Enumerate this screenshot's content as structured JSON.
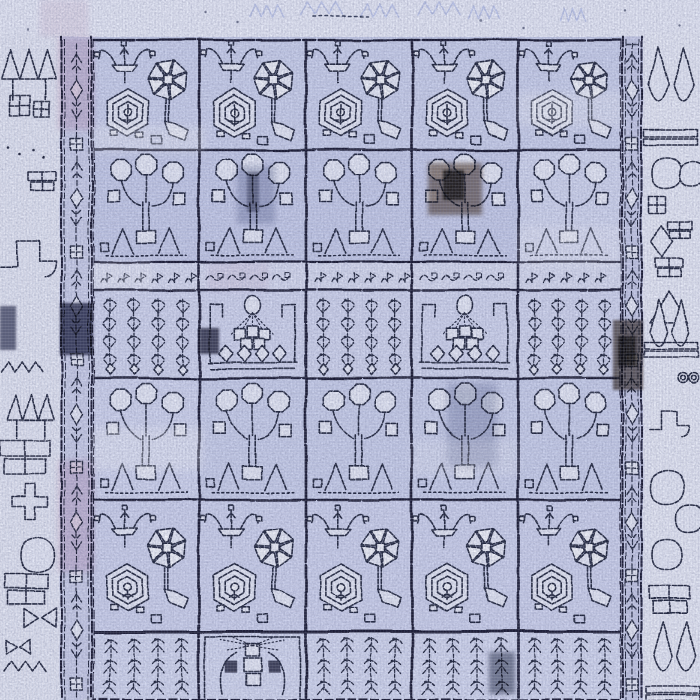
{
  "scene": {
    "description": "Worn blue and ivory Persian Bakhtiari-style panel rug, photographed flat: a grid of garden compartments with hexagon medallions, pinwheel flowers, balloon-flower bouquets, willow trees and niche baskets, framed by chain guard stripes and pale outer borders with geometric motifs",
    "palette": {
      "ink": "#1e2238",
      "ink_strong": "#14182e",
      "page_bg": "#e7eaf6",
      "top_strip": "#e9ecf9",
      "outer_left_bg": "#e6e9f6",
      "outer_right_bg": "#e9ecf8",
      "field_bg": "#c9cfec",
      "guard_bg": "#ccd0eb",
      "guard_bg_right": "#c8cce9",
      "band_bg": "#d9ddf2",
      "motif_light": "#e8ebf8",
      "motif_white": "#f3f5fc",
      "ghost": "#bfc8ec",
      "pink": "#dfaec4"
    },
    "field": {
      "x": 93,
      "y": 37,
      "w": 528,
      "h": 663
    },
    "cols": [
      {
        "x": 93,
        "w": 106
      },
      {
        "x": 199,
        "w": 107
      },
      {
        "x": 306,
        "w": 106
      },
      {
        "x": 412,
        "w": 106
      },
      {
        "x": 518,
        "w": 103
      }
    ],
    "rows": [
      {
        "name": "r1",
        "y": 40,
        "h": 110,
        "fill": "#ccd2ee",
        "types": [
          "garden",
          "garden",
          "garden",
          "garden",
          "garden"
        ]
      },
      {
        "name": "r2",
        "y": 150,
        "h": 112,
        "fill": "#c7cdeb",
        "types": [
          "balloons",
          "balloons",
          "balloons",
          "balloons",
          "balloons"
        ]
      },
      {
        "name": "band",
        "y": 262,
        "h": 28,
        "fill": "#d9ddf2",
        "types": [
          "glyphsA",
          "glyphsB",
          "glyphsA",
          "glyphsB",
          "glyphsA"
        ]
      },
      {
        "name": "r3",
        "y": 290,
        "h": 88,
        "fill": "#d2d7f0",
        "types": [
          "willow",
          "basket",
          "willow",
          "basket",
          "willow"
        ]
      },
      {
        "name": "r4",
        "y": 378,
        "h": 122,
        "fill": "#cbd1ed",
        "types": [
          "balloons",
          "balloons",
          "balloons",
          "balloons",
          "balloons"
        ]
      },
      {
        "name": "r5",
        "y": 500,
        "h": 132,
        "fill": "#cfd4ef",
        "types": [
          "garden",
          "garden",
          "garden",
          "garden",
          "garden"
        ]
      },
      {
        "name": "r6",
        "y": 632,
        "h": 68,
        "fill": "#d5daf2",
        "types": [
          "willowup",
          "fantree",
          "willowup",
          "willowup",
          "willowup"
        ]
      }
    ],
    "fill_overrides": [
      {
        "r": 1,
        "c": 4,
        "fill": "#d3d8f1"
      },
      {
        "r": 4,
        "c": 0,
        "fill": "#d2d7f1"
      }
    ],
    "guards": [
      {
        "name": "left-guard-stripe",
        "x": 60,
        "w": 33,
        "bg": "#ccd0eb"
      },
      {
        "name": "right-guard-stripe",
        "x": 621,
        "w": 22,
        "bg": "#c8cce9"
      }
    ],
    "outer_motifs": [
      {
        "t": "crown",
        "x": 2,
        "y": 46,
        "s": 54
      },
      {
        "t": "sqx",
        "x": 10,
        "y": 96,
        "s": 20
      },
      {
        "t": "sqx",
        "x": 34,
        "y": 102,
        "s": 15
      },
      {
        "t": "specks",
        "x": 8,
        "y": 148,
        "s": 40
      },
      {
        "t": "shelf",
        "x": 28,
        "y": 172,
        "s": 28
      },
      {
        "t": "hook",
        "x": 0,
        "y": 228,
        "s": 56
      },
      {
        "t": "birdm",
        "x": 2,
        "y": 362,
        "s": 48
      },
      {
        "t": "crown",
        "x": 8,
        "y": 392,
        "s": 46
      },
      {
        "t": "shelf",
        "x": 0,
        "y": 440,
        "s": 50
      },
      {
        "t": "cross",
        "x": 12,
        "y": 484,
        "s": 36
      },
      {
        "t": "blob",
        "x": 20,
        "y": 538,
        "s": 34
      },
      {
        "t": "shelf",
        "x": 4,
        "y": 574,
        "s": 44
      },
      {
        "t": "bowtie",
        "x": 24,
        "y": 608,
        "s": 32
      },
      {
        "t": "bowtie",
        "x": 6,
        "y": 640,
        "s": 24
      },
      {
        "t": "birdm",
        "x": 4,
        "y": 662,
        "s": 50
      },
      {
        "t": "leafpair",
        "x": 648,
        "y": 48,
        "s": 46
      },
      {
        "t": "hbar",
        "x": 644,
        "y": 130,
        "s": 54
      },
      {
        "t": "blob",
        "x": 652,
        "y": 158,
        "s": 30
      },
      {
        "t": "blob",
        "x": 680,
        "y": 162,
        "s": 24
      },
      {
        "t": "sqx",
        "x": 649,
        "y": 196,
        "s": 17
      },
      {
        "t": "diamond",
        "x": 651,
        "y": 226,
        "s": 22
      },
      {
        "t": "shelf",
        "x": 668,
        "y": 222,
        "s": 24
      },
      {
        "t": "shelf",
        "x": 655,
        "y": 258,
        "s": 28
      },
      {
        "t": "tri",
        "x": 650,
        "y": 292,
        "s": 38
      },
      {
        "t": "leafpair",
        "x": 650,
        "y": 300,
        "s": 40
      },
      {
        "t": "hbar",
        "x": 644,
        "y": 342,
        "s": 54
      },
      {
        "t": "scroll88",
        "x": 682,
        "y": 378,
        "s": 18
      },
      {
        "t": "hook",
        "x": 650,
        "y": 402,
        "s": 40
      },
      {
        "t": "blob",
        "x": 650,
        "y": 470,
        "s": 34
      },
      {
        "t": "blob",
        "x": 676,
        "y": 505,
        "s": 28
      },
      {
        "t": "blob",
        "x": 652,
        "y": 540,
        "s": 30
      },
      {
        "t": "shelf",
        "x": 650,
        "y": 586,
        "s": 40
      },
      {
        "t": "leafpair",
        "x": 654,
        "y": 622,
        "s": 42
      },
      {
        "t": "hbar",
        "x": 646,
        "y": 686,
        "s": 54
      }
    ],
    "top_strip": {
      "h": 37,
      "ghosts": [
        [
          250,
          4,
          40
        ],
        [
          300,
          2,
          50
        ],
        [
          360,
          4,
          46
        ],
        [
          418,
          2,
          50
        ],
        [
          468,
          6,
          36
        ],
        [
          560,
          8,
          30
        ]
      ],
      "dotted_line": [
        312,
        16,
        368,
        16
      ],
      "specks": [
        [
          238,
          22
        ],
        [
          480,
          20
        ],
        [
          523,
          28
        ],
        [
          205,
          12
        ],
        [
          624,
          10
        ],
        [
          680,
          26
        ],
        [
          28,
          30
        ]
      ]
    },
    "worn_patches": [
      {
        "x": 60,
        "y": 303,
        "w": 33,
        "h": 52,
        "c": "#262b47",
        "o": 0.85,
        "b": 1
      },
      {
        "x": 200,
        "y": 328,
        "w": 19,
        "h": 26,
        "c": "#1b1f33",
        "o": 0.8,
        "b": 1
      },
      {
        "x": 428,
        "y": 163,
        "w": 54,
        "h": 52,
        "c": "#6b5340",
        "o": 0.7,
        "b": 2
      },
      {
        "x": 443,
        "y": 170,
        "w": 21,
        "h": 30,
        "c": "#241c14",
        "o": 0.85,
        "b": 1
      },
      {
        "x": 237,
        "y": 166,
        "w": 38,
        "h": 58,
        "c": "#9aa0b8",
        "o": 0.55,
        "b": 3
      },
      {
        "x": 247,
        "y": 172,
        "w": 12,
        "h": 40,
        "c": "#3a4059",
        "o": 0.5,
        "b": 1
      },
      {
        "x": 447,
        "y": 383,
        "w": 50,
        "h": 84,
        "c": "#9aa0b8",
        "o": 0.5,
        "b": 4
      },
      {
        "x": 613,
        "y": 320,
        "w": 30,
        "h": 70,
        "c": "#4a3b2d",
        "o": 0.75,
        "b": 1
      },
      {
        "x": 618,
        "y": 336,
        "w": 18,
        "h": 30,
        "c": "#1c150e",
        "o": 0.8,
        "b": 1
      },
      {
        "x": 489,
        "y": 652,
        "w": 26,
        "h": 42,
        "c": "#2c3046",
        "o": 0.55,
        "b": 2
      },
      {
        "x": 0,
        "y": 306,
        "w": 16,
        "h": 44,
        "c": "#262b47",
        "o": 0.7,
        "b": 1
      }
    ],
    "pink_tints": [
      {
        "x": 58,
        "y": 38,
        "w": 36,
        "h": 92,
        "o": 0.4
      },
      {
        "x": 58,
        "y": 460,
        "w": 36,
        "h": 112,
        "o": 0.38
      },
      {
        "x": 40,
        "y": 0,
        "w": 48,
        "h": 36,
        "o": 0.22
      },
      {
        "x": 208,
        "y": 262,
        "w": 60,
        "h": 28,
        "o": 0.18
      }
    ],
    "light_streaks": [
      {
        "x": 93,
        "y": 126,
        "w": 112,
        "h": 26,
        "o": 0.28
      },
      {
        "x": 93,
        "y": 428,
        "w": 110,
        "h": 42,
        "o": 0.3
      },
      {
        "x": 518,
        "y": 92,
        "w": 104,
        "h": 34,
        "o": 0.25
      },
      {
        "x": 518,
        "y": 226,
        "w": 104,
        "h": 40,
        "o": 0.22
      },
      {
        "x": 412,
        "y": 440,
        "w": 106,
        "h": 36,
        "o": 0.2
      },
      {
        "x": 93,
        "y": 262,
        "w": 60,
        "h": 26,
        "o": 0.25
      }
    ]
  }
}
